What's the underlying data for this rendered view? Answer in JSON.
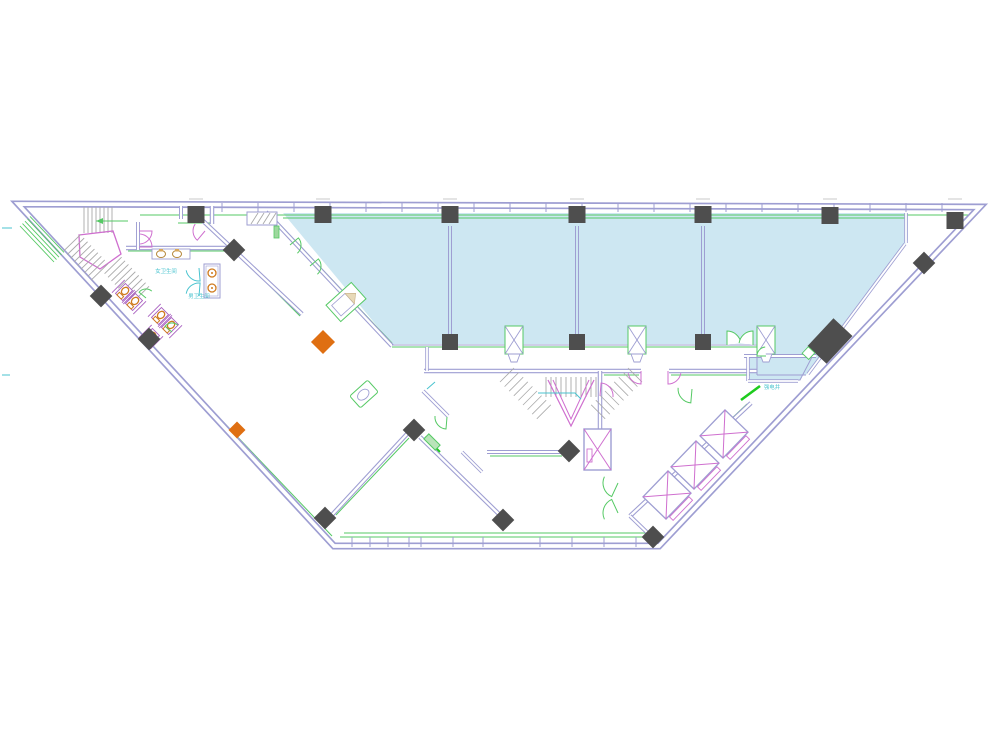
{
  "labels": [
    {
      "name": "womens-restroom",
      "text": "女卫生间"
    },
    {
      "name": "mens-restroom",
      "text": "男卫生间"
    },
    {
      "name": "electrical-shaft",
      "text": "强电井"
    }
  ],
  "colors": {
    "wall": "#9e9ed2",
    "green": "#55c964",
    "bright_green": "#1ecb1e",
    "cyan_fill": "#cde7f2",
    "cyan_line": "#49c3cf",
    "magenta": "#cf6fcf",
    "purple": "#a85fc0",
    "column_dark": "#4e4e4e",
    "orange": "#df6f12",
    "fixture_orange": "#cf7a1e",
    "stair_gray": "#a9a9a9",
    "mark_gray": "#c9c9c9"
  },
  "structure": {
    "top_columns": [
      [
        196,
        206
      ],
      [
        323,
        206
      ],
      [
        450,
        206
      ],
      [
        577,
        206
      ],
      [
        703,
        206
      ],
      [
        830,
        207
      ],
      [
        955,
        212
      ]
    ],
    "bottom_columns": [
      450,
      577,
      703
    ],
    "mullions": [
      450,
      577,
      703
    ],
    "diamond_columns": [
      [
        101,
        296
      ],
      [
        149,
        339
      ],
      [
        234,
        250
      ],
      [
        325,
        518
      ],
      [
        414,
        430
      ],
      [
        503,
        520
      ],
      [
        569,
        451
      ],
      [
        653,
        537
      ],
      [
        924,
        263
      ]
    ],
    "orange_markers": [
      [
        323,
        342,
        17
      ],
      [
        237,
        430,
        12
      ]
    ],
    "shaft_units": [
      514,
      637,
      766
    ],
    "elevator_bank": [
      [
        667,
        495
      ],
      [
        695,
        465
      ],
      [
        724,
        434
      ]
    ],
    "toilets": [
      [
        124,
        292
      ],
      [
        134,
        302
      ],
      [
        160,
        316
      ],
      [
        170,
        326
      ],
      [
        151,
        337
      ]
    ]
  }
}
